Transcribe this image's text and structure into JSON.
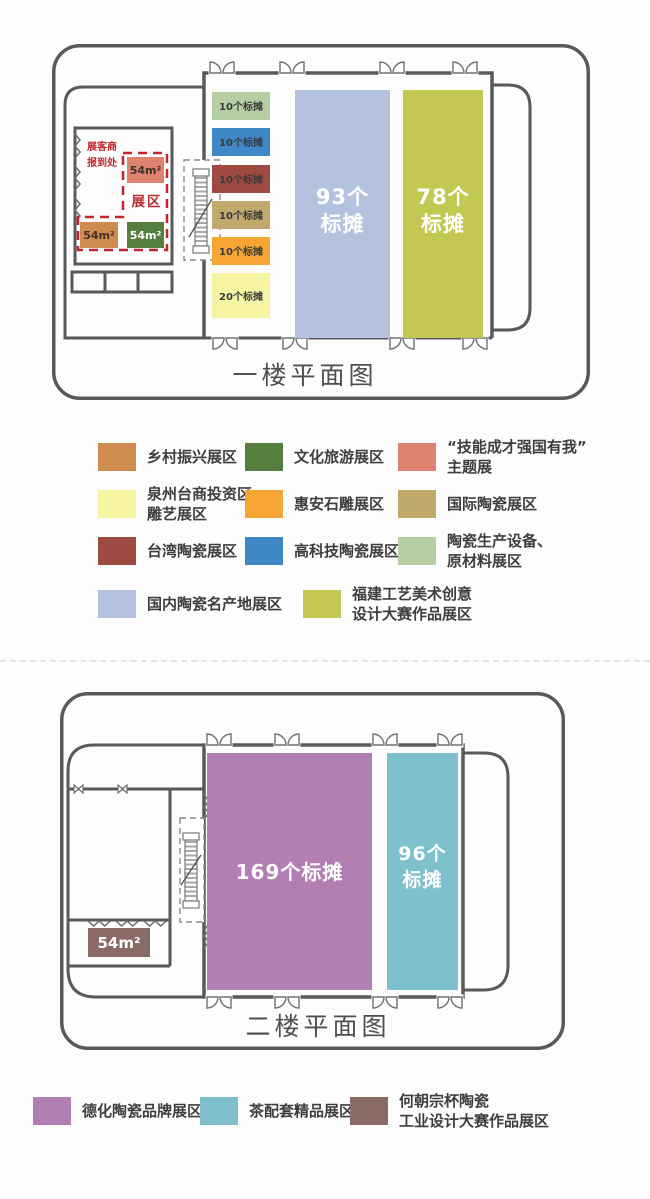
{
  "floor1": {
    "title": "一楼平面图",
    "reception": {
      "lines": [
        "展客商",
        "报到处"
      ]
    },
    "zone_label": "展区",
    "area_blocks": [
      {
        "label": "54m²",
        "color": "#dd8370",
        "text": "#432f28"
      },
      {
        "label": "54m²",
        "color": "#d08c4e",
        "text": "#432f28"
      },
      {
        "label": "54m²",
        "color": "#567e3e",
        "text": "#ffffff"
      }
    ],
    "booth_column": [
      {
        "label": "10个标摊",
        "color": "#b5cfa3"
      },
      {
        "label": "10个标摊",
        "color": "#3f87c5"
      },
      {
        "label": "10个标摊",
        "color": "#9d4b40"
      },
      {
        "label": "10个标摊",
        "color": "#c1a96d"
      },
      {
        "label": "10个标摊",
        "color": "#f7a636"
      },
      {
        "label": "20个标摊",
        "color": "#f6f3a2"
      }
    ],
    "hall_blocks": [
      {
        "lines": [
          "93个",
          "标摊"
        ],
        "color": "#b4c2e0"
      },
      {
        "lines": [
          "78个",
          "标摊"
        ],
        "color": "#c3c852"
      }
    ]
  },
  "legend1": {
    "items": [
      {
        "lines": [
          "乡村振兴展区"
        ],
        "color": "#d08c4e"
      },
      {
        "lines": [
          "文化旅游展区"
        ],
        "color": "#567e3e"
      },
      {
        "lines": [
          "“技能成才强国有我”",
          "主题展"
        ],
        "color": "#dd8370"
      },
      {
        "lines": [
          "泉州台商投资区",
          "雕艺展区"
        ],
        "color": "#f6f3a2"
      },
      {
        "lines": [
          "惠安石雕展区"
        ],
        "color": "#f7a636"
      },
      {
        "lines": [
          "国际陶瓷展区"
        ],
        "color": "#c1a96d"
      },
      {
        "lines": [
          "台湾陶瓷展区"
        ],
        "color": "#9d4b40"
      },
      {
        "lines": [
          "高科技陶瓷展区"
        ],
        "color": "#3f87c5"
      },
      {
        "lines": [
          "陶瓷生产设备、",
          "原材料展区"
        ],
        "color": "#b5cfa3"
      },
      {
        "lines": [
          "国内陶瓷名产地展区"
        ],
        "color": "#b4c2e0"
      },
      {
        "lines": [
          "福建工艺美术创意",
          "设计大赛作品展区"
        ],
        "color": "#c3c852"
      }
    ]
  },
  "floor2": {
    "title": "二楼平面图",
    "main_block": {
      "label": "169个标摊",
      "color": "#b27eb4"
    },
    "side_block": {
      "lines": [
        "96个",
        "标摊"
      ],
      "color": "#7ec1cd"
    },
    "small_block": {
      "label": "54m²",
      "color": "#8a6a64"
    }
  },
  "legend2": {
    "items": [
      {
        "lines": [
          "德化陶瓷品牌展区"
        ],
        "color": "#b27eb4"
      },
      {
        "lines": [
          "茶配套精品展区"
        ],
        "color": "#7ec1cd"
      },
      {
        "lines": [
          "何朝宗杯陶瓷",
          "工业设计大赛作品展区"
        ],
        "color": "#8a6a64"
      }
    ]
  }
}
